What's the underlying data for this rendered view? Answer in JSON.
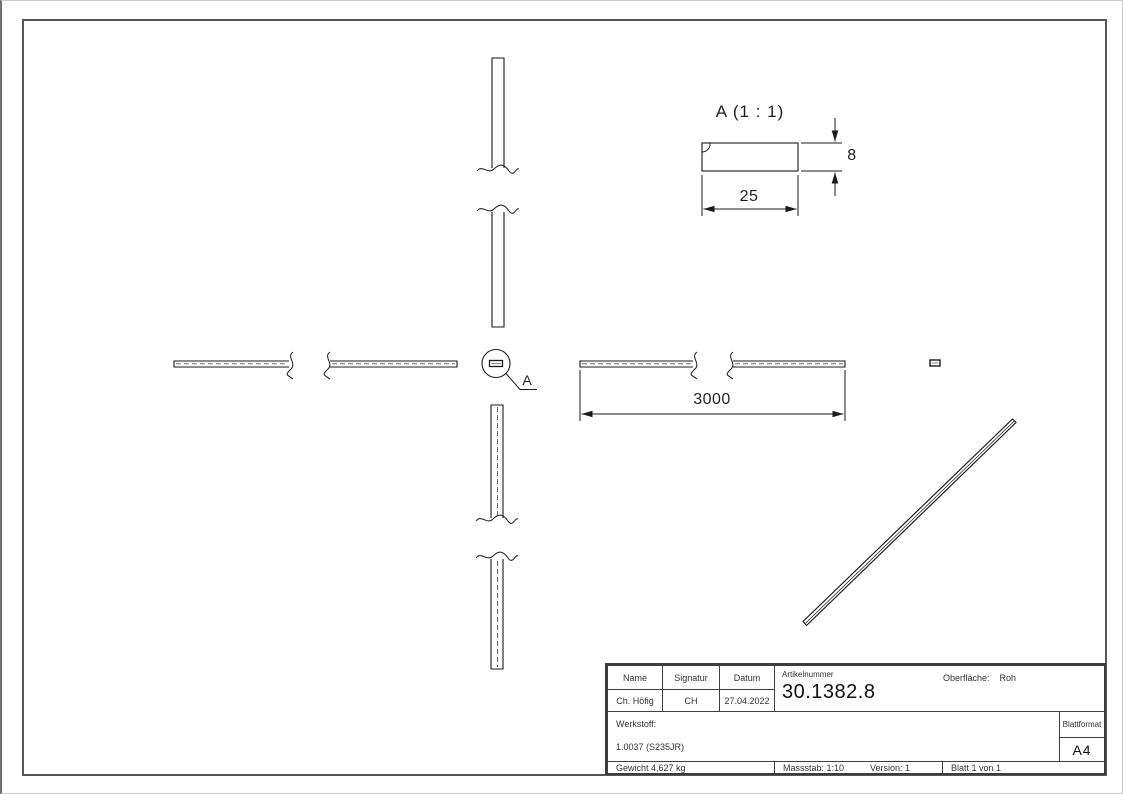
{
  "drawing": {
    "detail_view_label": "A (1 : 1)",
    "detail_callout_letter": "A",
    "dimensions": {
      "profile_width": "25",
      "profile_height": "8",
      "bar_length": "3000"
    }
  },
  "title_block": {
    "headers": {
      "name": "Name",
      "signature": "Signatur",
      "date": "Datum"
    },
    "values": {
      "name": "Ch. Höfig",
      "signature": "CH",
      "date": "27.04.2022"
    },
    "article_label": "Artikelnummer",
    "article_number": "30.1382.8",
    "surface_label": "Oberfläche:",
    "surface_value": "Roh",
    "material_label": "Werkstoff:",
    "material_value": "1.0037 (S235JR)",
    "weight": "Gewicht 4,627 kg",
    "scale": "Massstab: 1:10",
    "version": "Version: 1",
    "sheet": "Blatt 1 von 1",
    "format_label": "Blattformat",
    "format_value": "A4"
  },
  "colors": {
    "line": "#1a1a1a",
    "frame": "#555555",
    "hidden_line": "#555555"
  }
}
